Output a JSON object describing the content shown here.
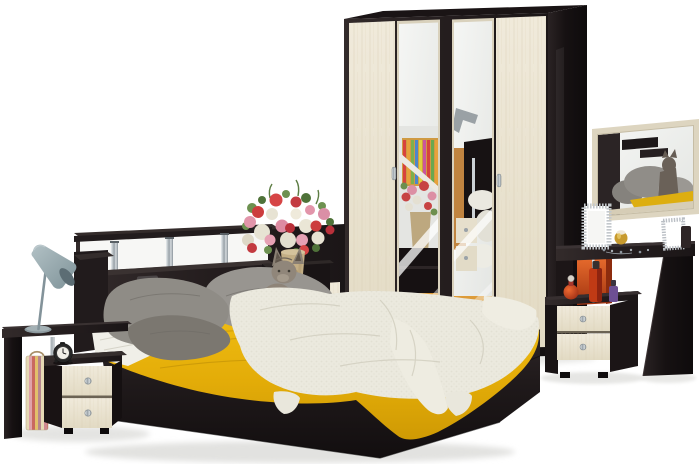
{
  "meta": {
    "domain": "natural-image",
    "title": "Bedroom furniture set product photo",
    "description": "Studio render of a wenge and cream-oak bedroom set: double bed with headboard shelf, yellow bedspread, white knitted throw, grey pillows and a cat; four-door wardrobe with two mirrored doors; two bedside cabinets with cream drawers; dressing table with cream-framed wall mirror; grey cone table lamp; alarm clock; striped bag; bouquet of red, pink and white flowers in a ceramic vase."
  },
  "palette": {
    "background": "#ffffff",
    "wenge_front": "#261f20",
    "wenge_side": "#161112",
    "cream_wood": "#e9e2d0",
    "mirror_glass": "#eef0ed",
    "yellow_bedspread": "#e8b50d",
    "white_throw": "#ebe9de",
    "grey_pillow": "#8f8c86",
    "chrome": "#aeb6bc",
    "lamp_grey": "#93a5ab",
    "orange_accent": "#d45a22",
    "floor_reflection": "#c98a3f",
    "vase_beige": "#c3ae85",
    "flower_red": "#cc3d3d",
    "flower_pink": "#e295aa",
    "flower_white": "#e7e3d3"
  },
  "objects": {
    "wardrobe": {
      "label": "four-door wardrobe with two mirrored doors",
      "doors": 4,
      "mirror_doors": 2,
      "knobs": 2
    },
    "bed": {
      "label": "double bed with headboard shelf on chrome posts",
      "posts": 3
    },
    "yellow_bedspread": {
      "label": "yellow bedspread"
    },
    "white_throw": {
      "label": "white knitted throw"
    },
    "pillows": {
      "label": "grey pillows"
    },
    "sheet": {
      "label": "white sheet"
    },
    "cat": {
      "label": "cat sitting on the bed"
    },
    "flowers": {
      "label": "bouquet of flowers in ceramic vase"
    },
    "left_console": {
      "label": "side console with table lamp"
    },
    "table_lamp": {
      "label": "grey cone table lamp"
    },
    "striped_bag": {
      "label": "striped paper bag"
    },
    "left_nightstand": {
      "label": "bedside cabinet with two cream drawers",
      "drawers": 2
    },
    "alarm_clock": {
      "label": "black round alarm clock"
    },
    "right_nightstand": {
      "label": "bedside cabinet with two cream drawers",
      "drawers": 2
    },
    "perfume_bottles": {
      "label": "perfume bottles",
      "count": 3
    },
    "dressing_table": {
      "label": "wenge dressing table"
    },
    "wall_mirror": {
      "label": "cream-framed wall mirror"
    },
    "picture_frames": {
      "label": "ornate silver picture frames",
      "count": 2
    },
    "remote": {
      "label": "remote on headboard ledge"
    }
  }
}
